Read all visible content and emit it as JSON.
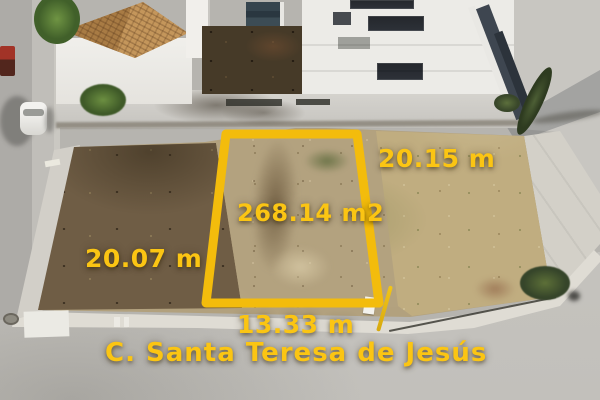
{
  "overlay": {
    "area": "268.14 m2",
    "side_right": "20.15 m",
    "side_left": "20.07 m",
    "frontage": "13.33 m",
    "street_name": "C. Santa Teresa de Jesús"
  },
  "colors": {
    "annotation-stroke": "#F3BC0C",
    "annotation-text": "#FBC513"
  }
}
